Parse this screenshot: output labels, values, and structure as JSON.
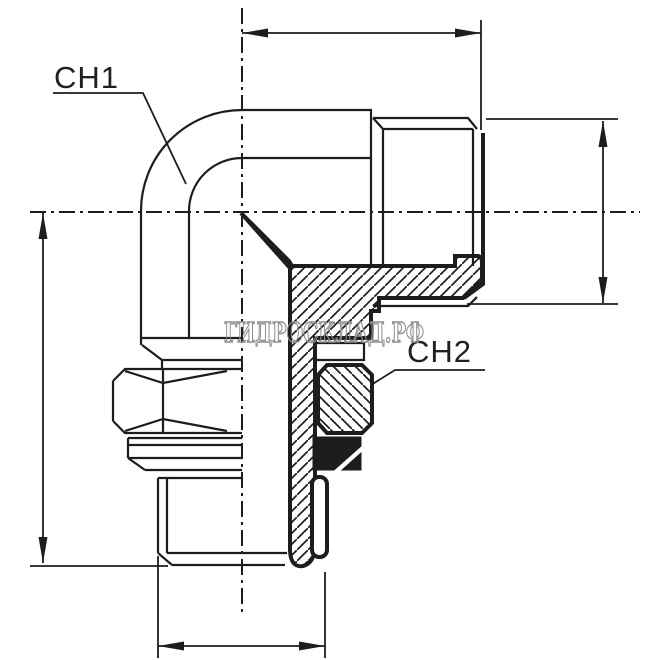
{
  "drawing": {
    "kind": "hydraulic-elbow-fitting-section-drawing",
    "labels": {
      "ch1": "CH1",
      "ch2": "CH2"
    },
    "watermark": "ГИДРОСКЛАД.РФ",
    "colors": {
      "line": "#1d1d1d",
      "watermark": "#8f8f8f",
      "background": "#ffffff"
    }
  }
}
